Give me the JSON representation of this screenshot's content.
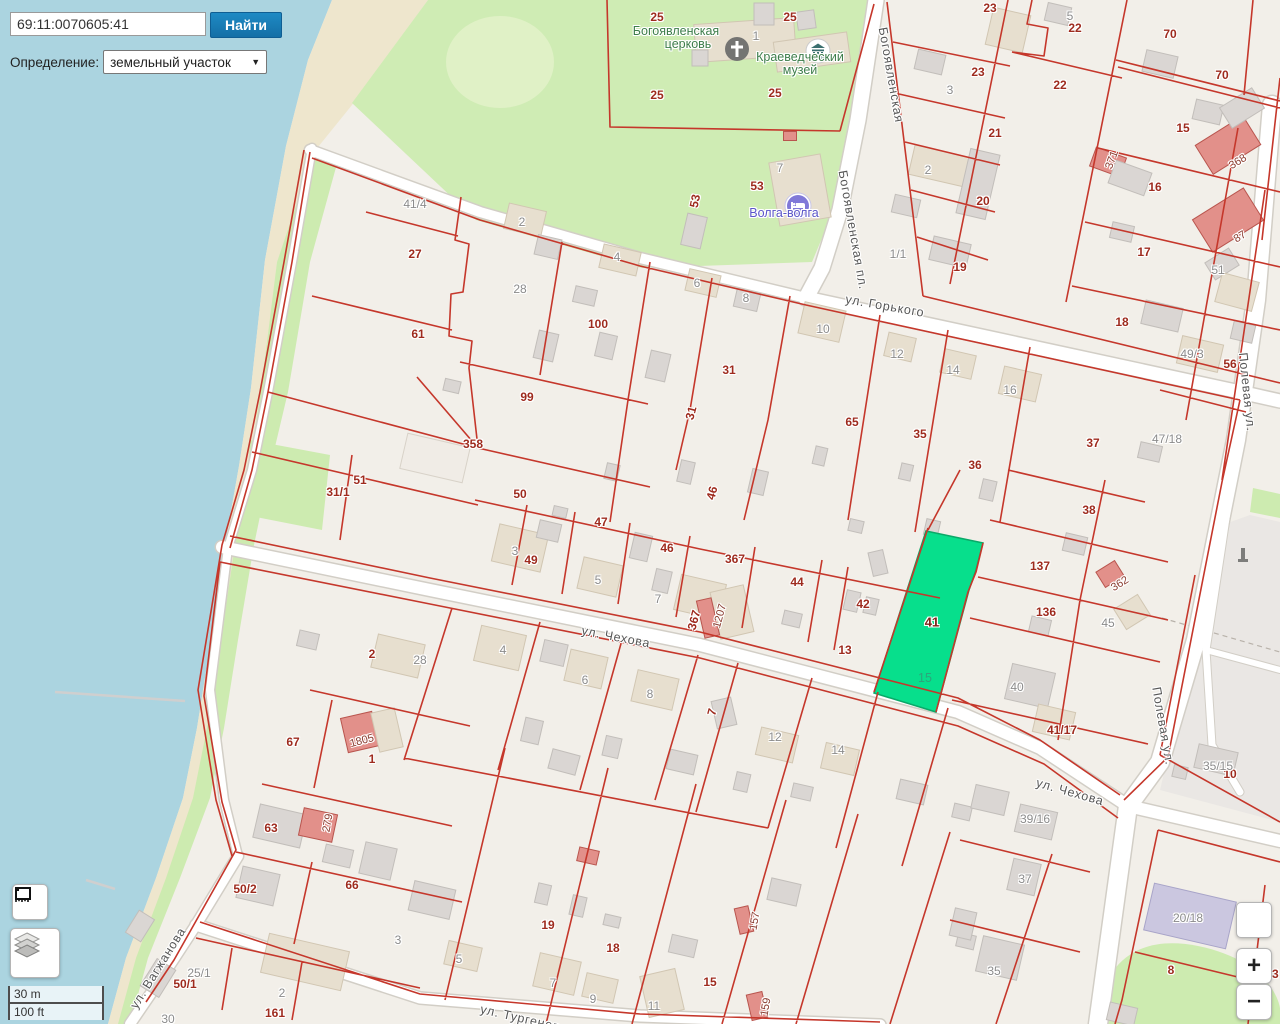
{
  "app": {
    "search_value": "69:11:0070605:41",
    "search_button": "Найти",
    "filter_label": "Определение:",
    "filter_value": "земельный участок",
    "caret_icon": "▼"
  },
  "controls": {
    "zoom_in": "+",
    "zoom_out": "−",
    "scale_metric": "30 m",
    "scale_imperial": "100 ft"
  },
  "colors": {
    "water": "#abd4e0",
    "green": "#cdebb0",
    "land": "#f2efe9",
    "parcel_line": "#c5372b",
    "selected_parcel_fill": "#07df8c",
    "button_blue": "#1879b5"
  },
  "selected": {
    "cadastral_number": "69:11:0070605:41",
    "parcel_label": "41",
    "building_label": "15"
  },
  "map": {
    "pois": {
      "church": {
        "line1": "Богоявленская",
        "line2": "церковь"
      },
      "museum": {
        "line1": "Краеведческий",
        "line2": "музей"
      },
      "hotel": {
        "name": "Волга-волга"
      }
    },
    "street_labels": [
      {
        "t": "ул. Горького",
        "x": 885,
        "y": 306,
        "r": 10
      },
      {
        "t": "Богоявленская пл.",
        "x": 853,
        "y": 230,
        "r": 80
      },
      {
        "t": "Богоявленская",
        "x": 891,
        "y": 75,
        "r": 80
      },
      {
        "t": "ул. Чехова",
        "x": 616,
        "y": 637,
        "r": 11
      },
      {
        "t": "ул. Чехова",
        "x": 1070,
        "y": 792,
        "r": 16
      },
      {
        "t": "Полевая ул.",
        "x": 1247,
        "y": 392,
        "r": 84
      },
      {
        "t": "Полевая ул.",
        "x": 1163,
        "y": 726,
        "r": 80
      },
      {
        "t": "ул. Вагжанова",
        "x": 158,
        "y": 968,
        "r": -58
      },
      {
        "t": "ул. Тургенева",
        "x": 524,
        "y": 1019,
        "r": 13
      }
    ],
    "parcel_labels": [
      {
        "t": "23",
        "x": 990,
        "y": 8
      },
      {
        "t": "22",
        "x": 1075,
        "y": 28
      },
      {
        "t": "70",
        "x": 1170,
        "y": 34
      },
      {
        "t": "23",
        "x": 978,
        "y": 72
      },
      {
        "t": "22",
        "x": 1060,
        "y": 85
      },
      {
        "t": "70",
        "x": 1222,
        "y": 75
      },
      {
        "t": "21",
        "x": 995,
        "y": 133
      },
      {
        "t": "15",
        "x": 1183,
        "y": 128
      },
      {
        "t": "20",
        "x": 983,
        "y": 201
      },
      {
        "t": "16",
        "x": 1155,
        "y": 187
      },
      {
        "t": "19",
        "x": 960,
        "y": 267
      },
      {
        "t": "17",
        "x": 1144,
        "y": 252
      },
      {
        "t": "18",
        "x": 1122,
        "y": 322
      },
      {
        "t": "56",
        "x": 1230,
        "y": 364
      },
      {
        "t": "25",
        "x": 657,
        "y": 17
      },
      {
        "t": "25",
        "x": 790,
        "y": 17
      },
      {
        "t": "25",
        "x": 657,
        "y": 95
      },
      {
        "t": "25",
        "x": 775,
        "y": 93
      },
      {
        "t": "53",
        "x": 757,
        "y": 186
      },
      {
        "t": "53",
        "x": 695,
        "y": 201,
        "r": -78
      },
      {
        "t": "27",
        "x": 415,
        "y": 254
      },
      {
        "t": "61",
        "x": 418,
        "y": 334
      },
      {
        "t": "100",
        "x": 598,
        "y": 324
      },
      {
        "t": "99",
        "x": 527,
        "y": 397
      },
      {
        "t": "31",
        "x": 729,
        "y": 370
      },
      {
        "t": "31",
        "x": 691,
        "y": 413,
        "r": -75
      },
      {
        "t": "65",
        "x": 852,
        "y": 422
      },
      {
        "t": "35",
        "x": 920,
        "y": 434
      },
      {
        "t": "358",
        "x": 473,
        "y": 444
      },
      {
        "t": "36",
        "x": 975,
        "y": 465
      },
      {
        "t": "37",
        "x": 1093,
        "y": 443
      },
      {
        "t": "51",
        "x": 360,
        "y": 480
      },
      {
        "t": "31/1",
        "x": 338,
        "y": 492
      },
      {
        "t": "50",
        "x": 520,
        "y": 494
      },
      {
        "t": "46",
        "x": 712,
        "y": 493,
        "r": -75
      },
      {
        "t": "38",
        "x": 1089,
        "y": 510
      },
      {
        "t": "47",
        "x": 601,
        "y": 522
      },
      {
        "t": "49",
        "x": 531,
        "y": 560
      },
      {
        "t": "46",
        "x": 667,
        "y": 548
      },
      {
        "t": "367",
        "x": 735,
        "y": 559
      },
      {
        "t": "137",
        "x": 1040,
        "y": 566
      },
      {
        "t": "44",
        "x": 797,
        "y": 582
      },
      {
        "t": "42",
        "x": 863,
        "y": 604
      },
      {
        "t": "367",
        "x": 694,
        "y": 620,
        "r": -75
      },
      {
        "t": "136",
        "x": 1046,
        "y": 612
      },
      {
        "t": "41/17",
        "x": 1062,
        "y": 730
      },
      {
        "t": "13",
        "x": 845,
        "y": 650
      },
      {
        "t": "2",
        "x": 372,
        "y": 654
      },
      {
        "t": "67",
        "x": 293,
        "y": 742
      },
      {
        "t": "1",
        "x": 372,
        "y": 759
      },
      {
        "t": "63",
        "x": 271,
        "y": 828
      },
      {
        "t": "50/2",
        "x": 245,
        "y": 889
      },
      {
        "t": "66",
        "x": 352,
        "y": 885
      },
      {
        "t": "50/1",
        "x": 185,
        "y": 984
      },
      {
        "t": "161",
        "x": 275,
        "y": 1013
      },
      {
        "t": "19",
        "x": 548,
        "y": 925
      },
      {
        "t": "18",
        "x": 613,
        "y": 948
      },
      {
        "t": "15",
        "x": 710,
        "y": 982
      },
      {
        "t": "7",
        "x": 712,
        "y": 712,
        "r": -75
      },
      {
        "t": "10",
        "x": 1230,
        "y": 774
      },
      {
        "t": "8",
        "x": 1171,
        "y": 970
      },
      {
        "t": "63",
        "x": 1272,
        "y": 974
      }
    ],
    "building_labels": [
      {
        "t": "3",
        "x": 950,
        "y": 90
      },
      {
        "t": "5",
        "x": 1070,
        "y": 16
      },
      {
        "t": "2",
        "x": 928,
        "y": 170
      },
      {
        "t": "1/1",
        "x": 898,
        "y": 254
      },
      {
        "t": "51",
        "x": 1218,
        "y": 270
      },
      {
        "t": "49/3",
        "x": 1192,
        "y": 354
      },
      {
        "t": "47/18",
        "x": 1167,
        "y": 439
      },
      {
        "t": "1",
        "x": 756,
        "y": 36
      },
      {
        "t": "7",
        "x": 780,
        "y": 168
      },
      {
        "t": "41/4",
        "x": 415,
        "y": 204
      },
      {
        "t": "28",
        "x": 520,
        "y": 289
      },
      {
        "t": "2",
        "x": 522,
        "y": 222
      },
      {
        "t": "4",
        "x": 617,
        "y": 257
      },
      {
        "t": "6",
        "x": 697,
        "y": 283
      },
      {
        "t": "8",
        "x": 746,
        "y": 298
      },
      {
        "t": "10",
        "x": 823,
        "y": 329
      },
      {
        "t": "12",
        "x": 897,
        "y": 354
      },
      {
        "t": "14",
        "x": 953,
        "y": 370
      },
      {
        "t": "16",
        "x": 1010,
        "y": 390
      },
      {
        "t": "3",
        "x": 515,
        "y": 551
      },
      {
        "t": "5",
        "x": 598,
        "y": 580
      },
      {
        "t": "7",
        "x": 658,
        "y": 599
      },
      {
        "t": "45",
        "x": 1108,
        "y": 623
      },
      {
        "t": "40",
        "x": 1017,
        "y": 687
      },
      {
        "t": "28",
        "x": 420,
        "y": 660
      },
      {
        "t": "4",
        "x": 503,
        "y": 650
      },
      {
        "t": "6",
        "x": 585,
        "y": 680
      },
      {
        "t": "8",
        "x": 650,
        "y": 694
      },
      {
        "t": "12",
        "x": 775,
        "y": 737
      },
      {
        "t": "14",
        "x": 838,
        "y": 750
      },
      {
        "t": "5",
        "x": 459,
        "y": 959
      },
      {
        "t": "7",
        "x": 553,
        "y": 983
      },
      {
        "t": "9",
        "x": 593,
        "y": 999
      },
      {
        "t": "11",
        "x": 654,
        "y": 1006
      },
      {
        "t": "25/1",
        "x": 199,
        "y": 973
      },
      {
        "t": "30",
        "x": 168,
        "y": 1019
      },
      {
        "t": "2",
        "x": 282,
        "y": 993
      },
      {
        "t": "3",
        "x": 398,
        "y": 940
      },
      {
        "t": "35",
        "x": 994,
        "y": 971
      },
      {
        "t": "37",
        "x": 1025,
        "y": 879
      },
      {
        "t": "39/16",
        "x": 1035,
        "y": 819
      },
      {
        "t": "35/15",
        "x": 1218,
        "y": 766
      },
      {
        "t": "20/18",
        "x": 1188,
        "y": 918
      }
    ],
    "red_building_labels": [
      {
        "t": "371",
        "x": 1112,
        "y": 160,
        "r": -70
      },
      {
        "t": "368",
        "x": 1238,
        "y": 162,
        "r": -32
      },
      {
        "t": "87",
        "x": 1240,
        "y": 237,
        "r": -32
      },
      {
        "t": "362",
        "x": 1120,
        "y": 584,
        "r": -32
      },
      {
        "t": "1207",
        "x": 720,
        "y": 616,
        "r": -75
      },
      {
        "t": "1805",
        "x": 362,
        "y": 741,
        "r": -15
      },
      {
        "t": "279",
        "x": 328,
        "y": 823,
        "r": -80
      },
      {
        "t": "157",
        "x": 755,
        "y": 921,
        "r": -80
      },
      {
        "t": "159",
        "x": 766,
        "y": 1007,
        "r": -80
      }
    ],
    "selected_labels": {
      "parcel": {
        "t": "41",
        "x": 932,
        "y": 622
      },
      "building": {
        "t": "15",
        "x": 925,
        "y": 678
      }
    }
  }
}
